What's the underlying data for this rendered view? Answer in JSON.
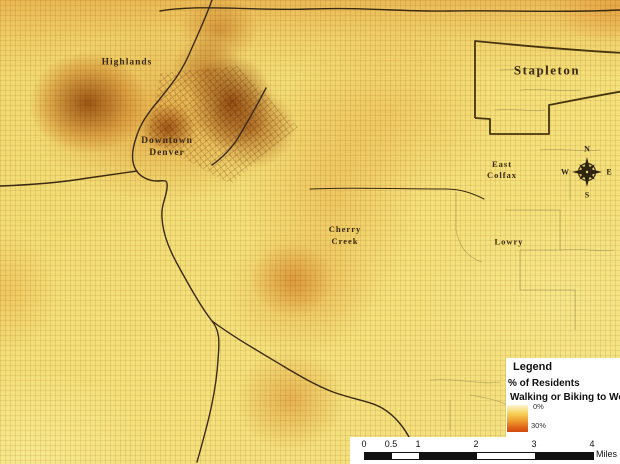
{
  "map": {
    "labels": {
      "highlands": "Highlands",
      "downtown_line1": "Downtown",
      "downtown_line2": "Denver",
      "stapleton": "Stapleton",
      "east_colfax_line1": "East",
      "east_colfax_line2": "Colfax",
      "cherry_creek_line1": "Cherry",
      "cherry_creek_line2": "Creek",
      "lowry": "Lowry"
    },
    "theme": "Kernel-density heat map of Denver neighborhoods",
    "colors": {
      "base_yellow": "#f4e17b",
      "hotspot_core": "#8a3c06",
      "mid_orange": "#d88a24",
      "road_line": "#3a2a12",
      "boundary_line": "#46340f"
    }
  },
  "legend": {
    "title": "Legend",
    "subtitle_line1": "% of Residents",
    "subtitle_line2": "Walking or Biking to Work",
    "ramp_min_label": "0%",
    "ramp_max_label": "30%",
    "ramp_min_value": 0,
    "ramp_max_value": 30,
    "ramp_colors": [
      "#fdf3cf",
      "#f7d35c",
      "#ee9c2e",
      "#e0661a",
      "#cf4b0d"
    ]
  },
  "scalebar": {
    "ticks": [
      "0",
      "0.5",
      "1",
      "2",
      "3",
      "4"
    ],
    "unit_label": "Miles"
  },
  "compass": {
    "north": "N",
    "east": "E",
    "south": "S",
    "west": "W"
  }
}
